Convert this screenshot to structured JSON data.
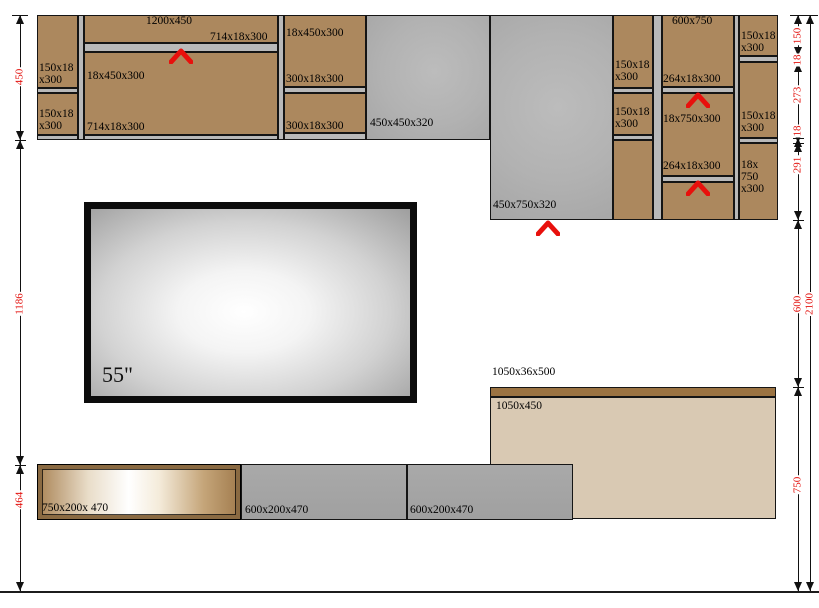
{
  "title": "Wall unit cabinet dimensioned drawing",
  "colors": {
    "brown": "#ac885e",
    "shelf": "#b9b9b9",
    "panelGray": "radial-gradient(circle at 55% 45%, #bcbcbc 0%, #b2b2b2 55%, #a6a6a6 100%)",
    "beige": "#d9c9b3",
    "darkBrown": "#9b7342",
    "drawerGray": "linear-gradient(180deg,#a9a9a9 0%,#a0a0a0 100%)",
    "drawerFace": "linear-gradient(90deg,#aa8456 0%,#e9ddc9 25%,#ffffff 45%,#f4ebda 60%,#c5a579 82%,#a17b4d 100%)",
    "accent_red": "#e8100c",
    "line": "#111111",
    "dim_text_red": "#e3130f"
  },
  "tv": {
    "label": "55\""
  },
  "panels": [
    {
      "name": "cabinet-left-top-section",
      "x": 37,
      "y": 15,
      "w": 41,
      "h": 73,
      "fill": "brown"
    },
    {
      "name": "cabinet-left-shelf",
      "x": 37,
      "y": 88,
      "w": 41,
      "h": 5,
      "fill": "shelf"
    },
    {
      "name": "cabinet-left-mid-section",
      "x": 37,
      "y": 93,
      "w": 41,
      "h": 42,
      "fill": "brown"
    },
    {
      "name": "cabinet-left-bottom-panel",
      "x": 37,
      "y": 135,
      "w": 41,
      "h": 5,
      "fill": "shelf"
    },
    {
      "name": "vertical-divider-1",
      "x": 78,
      "y": 15,
      "w": 6,
      "h": 125,
      "fill": "shelf"
    },
    {
      "name": "cabinet-main-top-section",
      "x": 84,
      "y": 15,
      "w": 194,
      "h": 28,
      "fill": "brown"
    },
    {
      "name": "cabinet-main-shelf",
      "x": 84,
      "y": 43,
      "w": 194,
      "h": 9,
      "fill": "shelf"
    },
    {
      "name": "cabinet-main-body",
      "x": 84,
      "y": 52,
      "w": 194,
      "h": 83,
      "fill": "brown"
    },
    {
      "name": "cabinet-main-bottom-panel",
      "x": 84,
      "y": 135,
      "w": 194,
      "h": 5,
      "fill": "shelf"
    },
    {
      "name": "vertical-divider-2",
      "x": 278,
      "y": 15,
      "w": 6,
      "h": 125,
      "fill": "shelf"
    },
    {
      "name": "cabinet-3-top-section",
      "x": 284,
      "y": 15,
      "w": 82,
      "h": 72,
      "fill": "brown"
    },
    {
      "name": "cabinet-3-shelf",
      "x": 284,
      "y": 87,
      "w": 82,
      "h": 6,
      "fill": "shelf"
    },
    {
      "name": "cabinet-3-mid-section",
      "x": 284,
      "y": 93,
      "w": 82,
      "h": 40,
      "fill": "brown"
    },
    {
      "name": "cabinet-3-bottom-panel",
      "x": 284,
      "y": 133,
      "w": 82,
      "h": 7,
      "fill": "shelf"
    },
    {
      "name": "gray-panel-450x450",
      "x": 366,
      "y": 15,
      "w": 124,
      "h": 125,
      "fill": "panelGray"
    },
    {
      "name": "gray-panel-450x750",
      "x": 490,
      "y": 15,
      "w": 123,
      "h": 205,
      "fill": "panelGray"
    },
    {
      "name": "cabinet-4-top-section",
      "x": 613,
      "y": 15,
      "w": 40,
      "h": 73,
      "fill": "brown"
    },
    {
      "name": "cabinet-4-shelf-1",
      "x": 613,
      "y": 88,
      "w": 40,
      "h": 5,
      "fill": "shelf"
    },
    {
      "name": "cabinet-4-mid-section",
      "x": 613,
      "y": 93,
      "w": 40,
      "h": 42,
      "fill": "brown"
    },
    {
      "name": "cabinet-4-shelf-2",
      "x": 613,
      "y": 135,
      "w": 40,
      "h": 5,
      "fill": "shelf"
    },
    {
      "name": "cabinet-4-bottom-section",
      "x": 613,
      "y": 140,
      "w": 40,
      "h": 80,
      "fill": "brown"
    },
    {
      "name": "vertical-divider-3",
      "x": 653,
      "y": 15,
      "w": 9,
      "h": 205,
      "fill": "shelf"
    },
    {
      "name": "cabinet-600x750-top-section",
      "x": 662,
      "y": 15,
      "w": 72,
      "h": 72,
      "fill": "brown"
    },
    {
      "name": "cabinet-600x750-shelf-1",
      "x": 662,
      "y": 87,
      "w": 72,
      "h": 6,
      "fill": "shelf"
    },
    {
      "name": "cabinet-600x750-mid-section",
      "x": 662,
      "y": 93,
      "w": 72,
      "h": 83,
      "fill": "brown"
    },
    {
      "name": "cabinet-600x750-shelf-2",
      "x": 662,
      "y": 176,
      "w": 72,
      "h": 6,
      "fill": "shelf"
    },
    {
      "name": "cabinet-600x750-bottom-section",
      "x": 662,
      "y": 182,
      "w": 72,
      "h": 38,
      "fill": "brown"
    },
    {
      "name": "vertical-divider-4",
      "x": 734,
      "y": 15,
      "w": 5,
      "h": 205,
      "fill": "shelf"
    },
    {
      "name": "cabinet-right-top-section",
      "x": 739,
      "y": 15,
      "w": 39,
      "h": 41,
      "fill": "brown"
    },
    {
      "name": "cabinet-right-shelf-1",
      "x": 739,
      "y": 56,
      "w": 39,
      "h": 6,
      "fill": "shelf"
    },
    {
      "name": "cabinet-right-mid-section",
      "x": 739,
      "y": 62,
      "w": 39,
      "h": 76,
      "fill": "brown"
    },
    {
      "name": "cabinet-right-shelf-2",
      "x": 739,
      "y": 138,
      "w": 39,
      "h": 5,
      "fill": "shelf"
    },
    {
      "name": "cabinet-right-bottom-section",
      "x": 739,
      "y": 143,
      "w": 39,
      "h": 77,
      "fill": "brown"
    },
    {
      "name": "counter-top-strip-1050x36x500",
      "x": 490,
      "y": 387,
      "w": 286,
      "h": 10,
      "fill": "darkBrown"
    },
    {
      "name": "counter-panel-1050x450",
      "x": 490,
      "y": 397,
      "w": 286,
      "h": 122,
      "fill": "beige"
    },
    {
      "name": "drawer-600x200x470-a",
      "x": 241,
      "y": 464,
      "w": 166,
      "h": 56,
      "fill": "drawerGray"
    },
    {
      "name": "drawer-600x200x470-b",
      "x": 407,
      "y": 464,
      "w": 166,
      "h": 56,
      "fill": "drawerGray"
    },
    {
      "name": "drawer-750x200x470",
      "x": 37,
      "y": 464,
      "w": 204,
      "h": 56,
      "fill": "drawerFace",
      "frame": true
    }
  ],
  "labels": [
    {
      "t": "1200x450",
      "x": 146,
      "y": 15
    },
    {
      "t": "714x18x300",
      "x": 210,
      "y": 31
    },
    {
      "t": "150x18\nx300",
      "x": 39,
      "y": 62
    },
    {
      "t": "150x18\nx300",
      "x": 39,
      "y": 108
    },
    {
      "t": "18x450x300",
      "x": 87,
      "y": 70
    },
    {
      "t": "714x18x300",
      "x": 87,
      "y": 121
    },
    {
      "t": "18x450x300",
      "x": 286,
      "y": 27
    },
    {
      "t": "300x18x300",
      "x": 286,
      "y": 73
    },
    {
      "t": "300x18x300",
      "x": 286,
      "y": 120
    },
    {
      "t": "450x450x320",
      "x": 370,
      "y": 117
    },
    {
      "t": "450x750x320",
      "x": 493,
      "y": 199
    },
    {
      "t": "150x18\nx300",
      "x": 615,
      "y": 59
    },
    {
      "t": "150x18\nx300",
      "x": 615,
      "y": 106
    },
    {
      "t": "600x750",
      "x": 672,
      "y": 15
    },
    {
      "t": "264x18x300",
      "x": 663,
      "y": 73
    },
    {
      "t": "18x750x300",
      "x": 663,
      "y": 113
    },
    {
      "t": "264x18x300",
      "x": 663,
      "y": 160
    },
    {
      "t": "150x18\nx300",
      "x": 741,
      "y": 30
    },
    {
      "t": "150x18\nx300",
      "x": 741,
      "y": 110
    },
    {
      "t": "18x\n750\nx300",
      "x": 741,
      "y": 159
    },
    {
      "t": "1050x36x500",
      "x": 492,
      "y": 366
    },
    {
      "t": "1050x450",
      "x": 496,
      "y": 400
    },
    {
      "t": "750x200x 470",
      "x": 42,
      "y": 502
    },
    {
      "t": "600x200x470",
      "x": 245,
      "y": 504
    },
    {
      "t": "600x200x470",
      "x": 410,
      "y": 504
    }
  ],
  "carets": [
    {
      "x": 169,
      "y": 48
    },
    {
      "x": 536,
      "y": 220
    },
    {
      "x": 686,
      "y": 92
    },
    {
      "x": 686,
      "y": 180
    }
  ],
  "dim_lines": [
    {
      "name": "dim-line-left",
      "x": 20,
      "y1": 15,
      "y2": 591,
      "topbar": true,
      "boundaries": [
        15,
        140,
        465,
        591
      ],
      "labels": [
        {
          "t": "450",
          "cy": 77
        },
        {
          "t": "1186",
          "cy": 304
        },
        {
          "t": "464",
          "cy": 500
        }
      ]
    },
    {
      "name": "dim-line-right-inner",
      "x": 798,
      "y1": 15,
      "y2": 591,
      "topbar": true,
      "boundaries": [
        15,
        56,
        63,
        138,
        143,
        220,
        387,
        591
      ],
      "labels": [
        {
          "t": "150",
          "cy": 36
        },
        {
          "t": "18",
          "cy": 60
        },
        {
          "t": "273",
          "cy": 95
        },
        {
          "t": "18",
          "cy": 131
        },
        {
          "t": "291",
          "cy": 165
        },
        {
          "t": "600",
          "cy": 304
        },
        {
          "t": "750",
          "cy": 485
        }
      ]
    },
    {
      "name": "dim-line-right-outer",
      "x": 810,
      "y1": 15,
      "y2": 591,
      "topbar": true,
      "boundaries": [
        15,
        591
      ],
      "labels": [
        {
          "t": "2100",
          "cy": 304
        }
      ]
    }
  ],
  "floor": {
    "y": 591
  }
}
